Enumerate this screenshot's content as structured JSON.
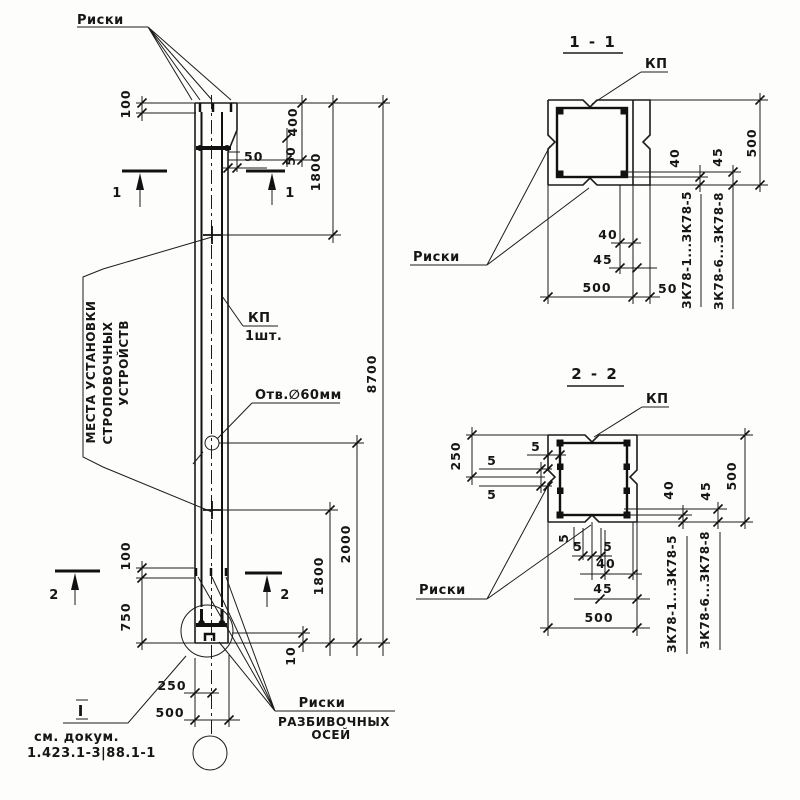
{
  "labels": {
    "risks_top": "Риски",
    "lifting_1": "МЕСТА УСТАНОВКИ",
    "lifting_2": "СТРОПОВОЧНЫХ",
    "lifting_3": "УСТРОЙСТВ",
    "kp": "КП",
    "kp_qty": "1шт.",
    "hole": "Отв.∅60мм",
    "axes_1": "Риски",
    "axes_2": "РАЗБИВОЧНЫХ",
    "axes_3": "ОСЕЙ",
    "detail_mark": "I",
    "see_doc_1": "см. докум.",
    "see_doc_2": "1.423.1-3|88.1-1",
    "cut_1": "1",
    "cut_2": "2"
  },
  "dims": {
    "m100t": "100",
    "m400": "400",
    "m50v": "50",
    "m50h": "50",
    "m1800t": "1800",
    "m8700": "8700",
    "m2000": "2000",
    "m1800b": "1800",
    "m100b": "100",
    "m750": "750",
    "m10": "10",
    "m250": "250",
    "m500": "500"
  },
  "section1": {
    "title": "1 - 1",
    "kp": "КП",
    "risks": "Риски",
    "r40": "40",
    "r45": "45",
    "r500": "500",
    "b40": "40",
    "b45": "45",
    "b500": "500",
    "b50": "50",
    "mark_a": "ЗК78-1...ЗК78-5",
    "mark_b": "ЗК78-6...ЗК78-8"
  },
  "section2": {
    "title": "2 - 2",
    "kp": "КП",
    "risks": "Риски",
    "l250": "250",
    "l5a": "5",
    "l5b": "5",
    "l5c": "5",
    "b5a": "5",
    "b5b": "5",
    "b5c": "5",
    "r40": "40",
    "r45": "45",
    "r500": "500",
    "b40": "40",
    "b45": "45",
    "b500": "500",
    "mark_a": "ЗК78-1...ЗК78-5",
    "mark_b": "ЗК78-6...ЗК78-8"
  }
}
